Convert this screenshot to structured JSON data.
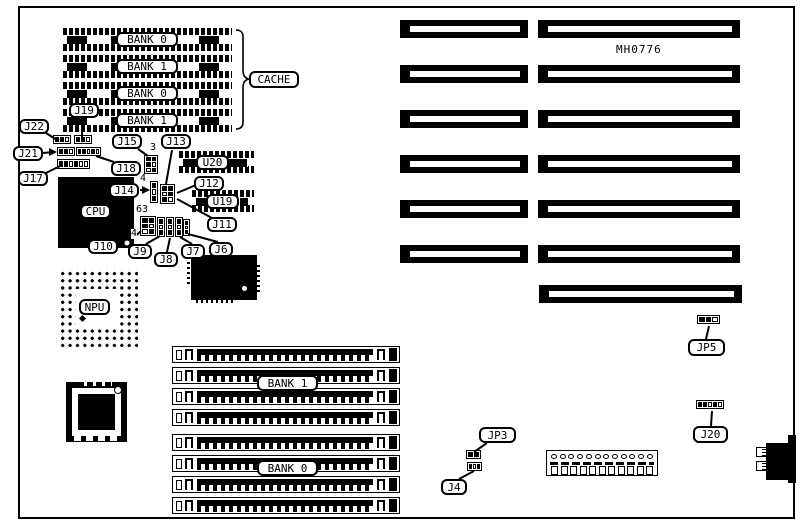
{
  "figure": {
    "part_number": "MH0776"
  },
  "cache": {
    "label": "CACHE",
    "banks": [
      "BANK 0",
      "BANK 1",
      "BANK 0",
      "BANK 1"
    ]
  },
  "simm": {
    "bank1": "BANK 1",
    "bank0": "BANK 0"
  },
  "chips": {
    "cpu": "CPU",
    "npu": "NPU",
    "u20": "U20",
    "u19": "U19"
  },
  "jumpers": {
    "j22": "J22",
    "j21": "J21",
    "j19": "J19",
    "j18": "J18",
    "j17": "J17",
    "j15": "J15",
    "j14": "J14",
    "j13": "J13",
    "j12": "J12",
    "j11": "J11",
    "j10": "J10",
    "j9": "J9",
    "j8": "J8",
    "j7": "J7",
    "j6": "J6",
    "j4": "J4",
    "jp3": "JP3",
    "jp5": "JP5",
    "j20": "J20"
  },
  "pin_markers": {
    "pin3": "3",
    "pin4_top": "4",
    "pin63": "63",
    "pin4_left": "4"
  },
  "power_connector": {
    "top_pin_count": 12,
    "bottom_slot_count": 11
  }
}
